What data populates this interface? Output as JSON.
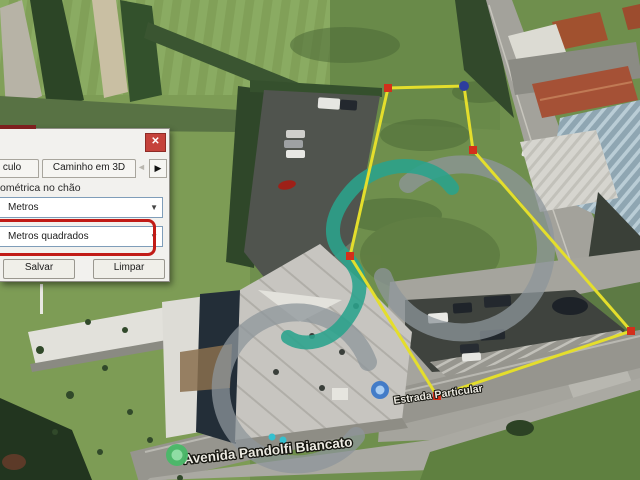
{
  "ruler_dialog": {
    "close": "✕",
    "tabs": [
      {
        "label": "culo"
      },
      {
        "label": "Caminho em 3D"
      }
    ],
    "tab_nav": {
      "prev": "◄",
      "next": "▶"
    },
    "ground_text": "ométrica no chão",
    "length_unit_value": "Metros",
    "area_unit_value": "Metros quadrados",
    "dropdown_arrow": "▼",
    "save_label": "Salvar",
    "clear_label": "Limpar",
    "highlight_color": "#c11b17"
  },
  "map": {
    "street_label_main": "Avenida Pandolfi Biancato",
    "street_label_secondary": "Estrada Particular",
    "measurement": {
      "stroke_color": "#e4de2c",
      "vertex_fill": "#d32f1b",
      "active_vertex_fill": "#2c3d9e",
      "vertices": [
        {
          "x": 388,
          "y": 88,
          "type": "square"
        },
        {
          "x": 464,
          "y": 86,
          "type": "dot"
        },
        {
          "x": 473,
          "y": 150,
          "type": "square"
        },
        {
          "x": 631,
          "y": 331,
          "type": "square"
        },
        {
          "x": 437,
          "y": 396,
          "type": "square"
        },
        {
          "x": 350,
          "y": 256,
          "type": "square"
        }
      ]
    },
    "markers": {
      "pin": {
        "x": 380,
        "y": 390
      },
      "green_dot": {
        "x": 177,
        "y": 455
      }
    },
    "watermark": {
      "teal": "#2aa38c",
      "gray": "#8d959b"
    }
  }
}
